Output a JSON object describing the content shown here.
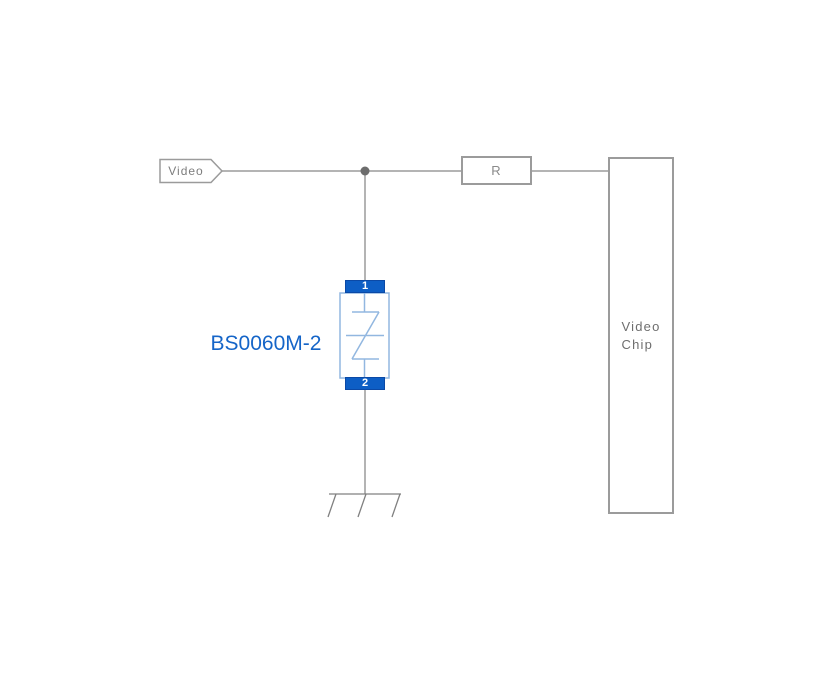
{
  "diagram": {
    "type": "circuit-schematic",
    "net_label": {
      "text": "Video"
    },
    "resistor": {
      "label": "R"
    },
    "chip": {
      "lines": [
        "Video",
        "Chip"
      ]
    },
    "tvs": {
      "part_number": "BS0060M-2",
      "pin_top": "1",
      "pin_bottom": "2",
      "symbol": "bidirectional-tvs-diode"
    },
    "ground": {
      "style": "chassis-ground"
    },
    "colors": {
      "wire": "#9b9b9b",
      "junction": "#6d6d6d",
      "box_border": "#9b9b9b",
      "text_gray": "#7d7d7d",
      "tvs_symbol_blue": "#92b7e0",
      "tvs_pin_fill": "#0d5ec5",
      "part_number_blue": "#1565c8",
      "background": "#ffffff"
    }
  }
}
